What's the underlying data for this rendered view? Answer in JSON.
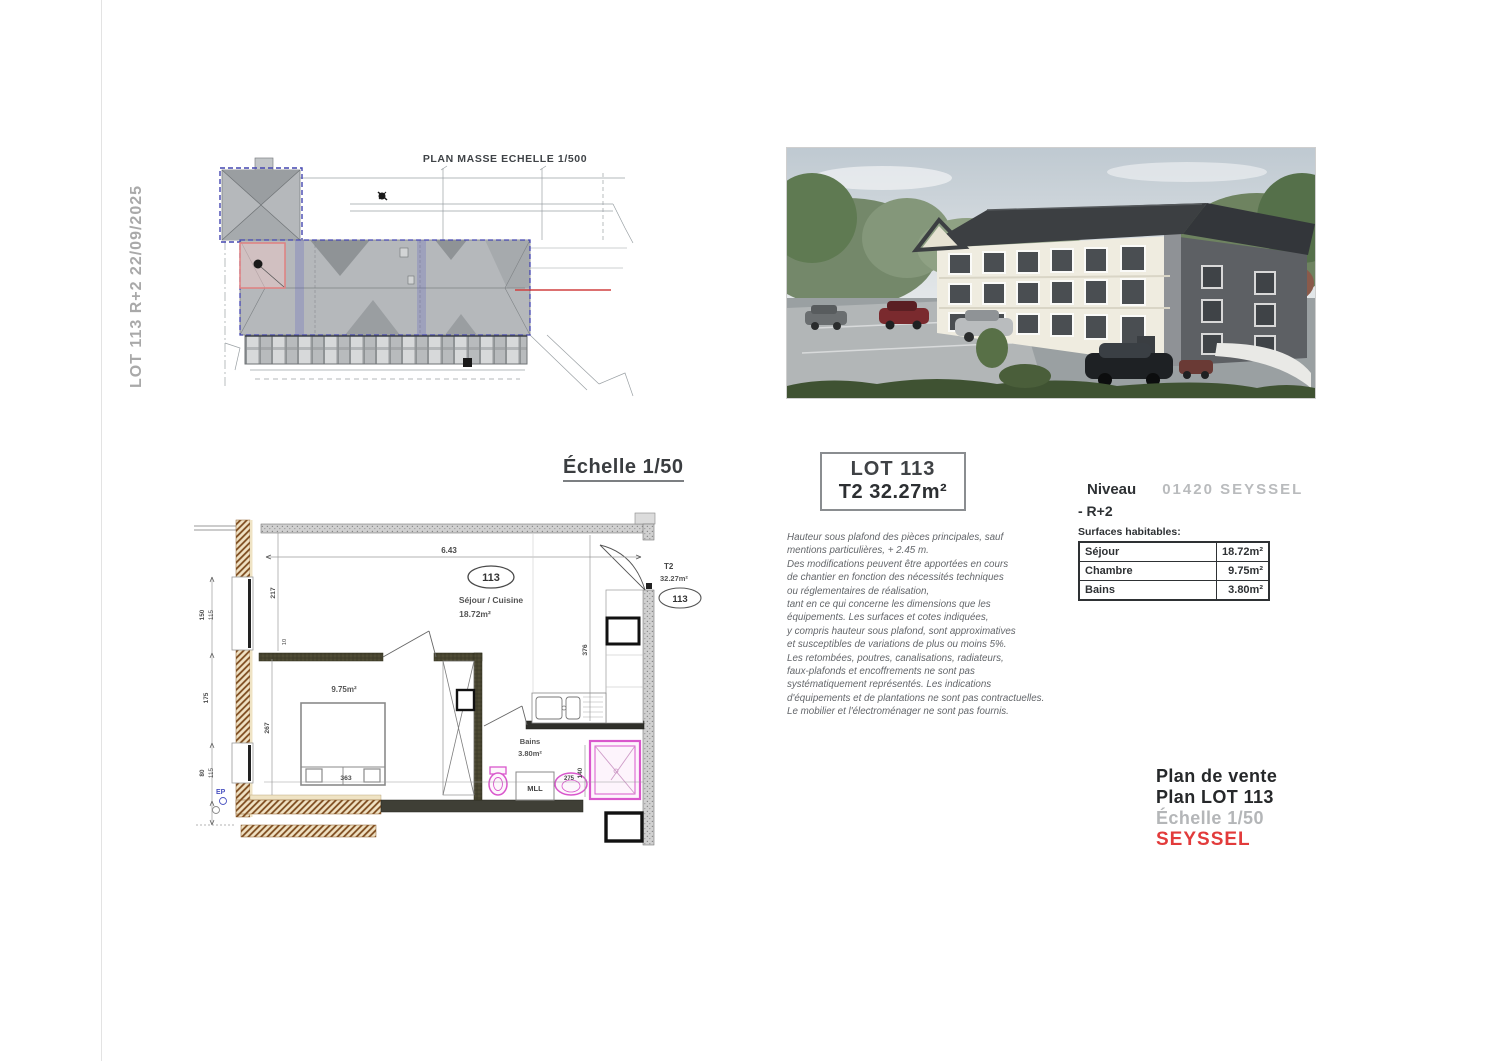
{
  "sheet": {
    "vertical_label": "LOT 113 R+2  22/09/2025"
  },
  "site_plan": {
    "title": "PLAN MASSE ECHELLE 1/500"
  },
  "floor_plan": {
    "title": "Échelle 1/50",
    "unit_oval": "113",
    "room_main": "Séjour / Cuisine",
    "room_main_area": "18.72m²",
    "bedroom_area": "9.75m²",
    "bath_label": "Bains",
    "bath_area": "3.80m²",
    "washer_label": "MLL",
    "type_label": "T2",
    "type_area": "32.27m²",
    "unit_oval_right": "113",
    "dims": {
      "top": "6.43",
      "left_inner": "217",
      "left_small": "10",
      "bedroom_left": "267",
      "hall": "376",
      "bed": "363",
      "sink": "275",
      "shower": "140",
      "chain_top_a": "150",
      "chain_top_b": "115",
      "chain_mid": "175",
      "chain_bot_a": "80",
      "chain_bot_b": "115",
      "ep": "EP"
    }
  },
  "lot_box": {
    "line1": "LOT 113",
    "line2": "T2 32.27m²"
  },
  "disclaimer": {
    "lines": [
      "Hauteur sous plafond des pièces principales, sauf",
      "mentions particulières, + 2.45 m.",
      "Des modifications peuvent être apportées en cours",
      "de chantier en fonction des nécessités techniques",
      "ou réglementaires de réalisation,",
      "tant en ce qui concerne les dimensions que les",
      "équipements. Les surfaces et cotes indiquées,",
      "y compris hauteur sous plafond, sont approximatives",
      "et susceptibles de variations de plus ou moins 5%.",
      "Les retombées, poutres, canalisations, radiateurs,",
      "faux-plafonds et encoffrements ne sont pas",
      "systématiquement représentés. Les indications",
      "d'équipements et de plantations ne sont pas contractuelles.",
      "Le mobilier et l'électroménager ne sont pas fournis."
    ]
  },
  "niveau": {
    "label": "Niveau",
    "city": "01420 SEYSSEL",
    "level": "- R+2",
    "surfaces_label": "Surfaces habitables:",
    "table": [
      {
        "room": "Séjour",
        "area": "18.72m²"
      },
      {
        "room": "Chambre",
        "area": "9.75m²"
      },
      {
        "room": "Bains",
        "area": "3.80m²"
      }
    ]
  },
  "footer": {
    "line1": "Plan de vente",
    "line2": "Plan LOT 113",
    "line3": "Échelle 1/50",
    "line4": "SEYSSEL"
  },
  "colors": {
    "accent_red": "#e23b3b",
    "magenta_fixture": "#d957cc",
    "blueprint_blue": "#4446b0",
    "muted_gray": "#b4b6b8"
  }
}
